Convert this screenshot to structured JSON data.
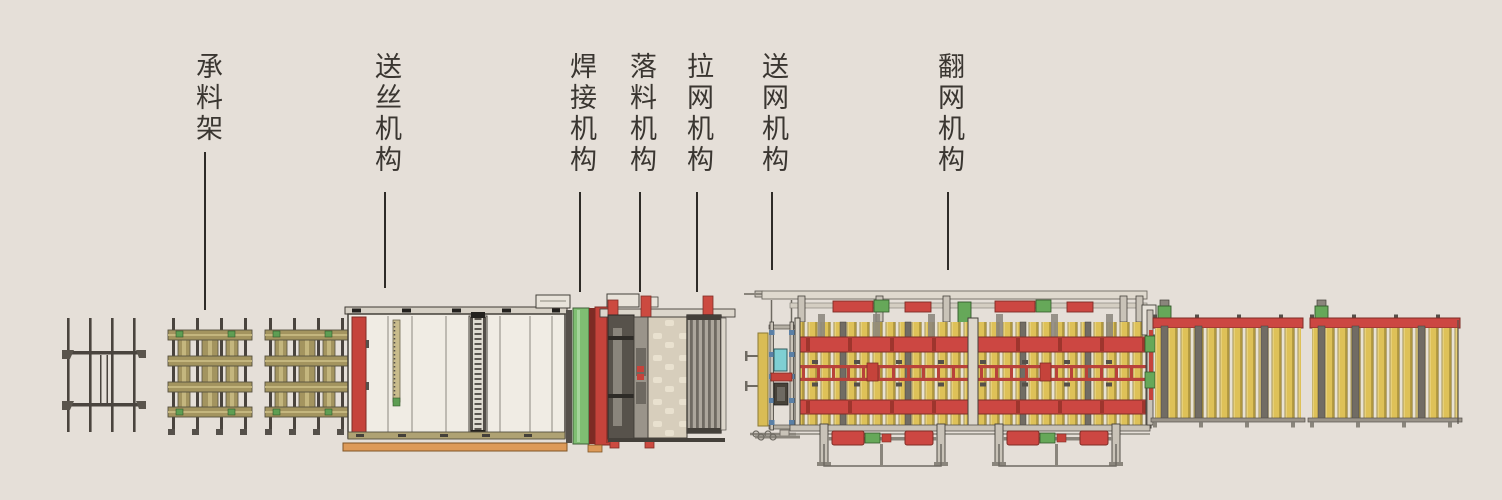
{
  "diagram": {
    "title": "mesh-welding-production-line-layout",
    "background_color": "#E5DFD8",
    "label_color": "#3A3631",
    "labels": [
      {
        "id": "material-rack",
        "text": "承料架"
      },
      {
        "id": "wire-feeding",
        "text": "送丝机构"
      },
      {
        "id": "welding",
        "text": "焊接机构"
      },
      {
        "id": "blanking",
        "text": "落料机构"
      },
      {
        "id": "mesh-pulling",
        "text": "拉网机构"
      },
      {
        "id": "mesh-feeding",
        "text": "送网机构"
      },
      {
        "id": "mesh-flipping",
        "text": "翻网机构"
      }
    ],
    "machines": [
      {
        "id": "material-rack",
        "label": "承料架"
      },
      {
        "id": "wire-feeding",
        "label": "送丝机构"
      },
      {
        "id": "welding",
        "label": "焊接机构"
      },
      {
        "id": "blanking",
        "label": "落料机构"
      },
      {
        "id": "mesh-pulling",
        "label": "拉网机构"
      },
      {
        "id": "mesh-feeding",
        "label": "送网机构"
      },
      {
        "id": "mesh-flipping",
        "label": "翻网机构"
      },
      {
        "id": "roller-conveyor-1",
        "label": ""
      },
      {
        "id": "roller-conveyor-2",
        "label": ""
      }
    ],
    "colors": {
      "red": "#C5433B",
      "dark_red": "#7E2D26",
      "green": "#6FAE60",
      "yellow_roller": "#DEC158",
      "khaki": "#A3945F",
      "orange": "#DD9A58",
      "cyan": "#7FCFD3",
      "steel_gray": "#C9C3B8",
      "dark_frame": "#4A443E"
    }
  }
}
